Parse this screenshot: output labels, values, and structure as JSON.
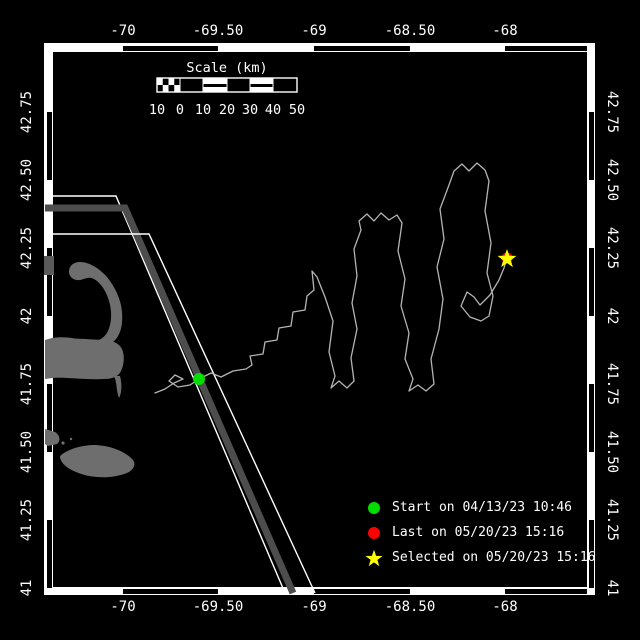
{
  "axes": {
    "top": {
      "labels": [
        "-70",
        "-69.50",
        "-69",
        "-68.50",
        "-68"
      ]
    },
    "bottom": {
      "labels": [
        "-70",
        "-69.50",
        "-69",
        "-68.50",
        "-68"
      ]
    },
    "left": {
      "labels": [
        "42.75",
        "42.50",
        "42.25",
        "42",
        "41.75",
        "41.50",
        "41.25",
        "41"
      ]
    },
    "right": {
      "labels": [
        "42.75",
        "42.50",
        "42.25",
        "42",
        "41.75",
        "41.50",
        "41.25",
        "41"
      ]
    }
  },
  "scale_bar": {
    "title": "Scale (km)",
    "tick_labels": [
      "10",
      "0",
      "10",
      "20",
      "30",
      "40",
      "50"
    ]
  },
  "legend": {
    "items": [
      {
        "icon": "start-dot-icon",
        "color": "#00dd00",
        "label": "Start on 04/13/23 10:46"
      },
      {
        "icon": "last-dot-icon",
        "color": "#ff0000",
        "label": "Last on 05/20/23 15:16"
      },
      {
        "icon": "selected-star-icon",
        "color": "#ffff00",
        "label": "Selected on 05/20/23 15:16"
      }
    ]
  },
  "colors": {
    "background": "#000000",
    "frame": "#ffffff",
    "land": "#6e6e6e",
    "shipping_lane": "#4d4d4d",
    "track": "#b4b4b4",
    "start_marker": "#00dd00",
    "last_marker": "#ff0000",
    "selected_marker": "#ffff00"
  },
  "map": {
    "start_point": {
      "x": 199,
      "y": 379
    },
    "last_point": {
      "x": 507,
      "y": 258
    },
    "selected_point": {
      "x": 507,
      "y": 259
    },
    "track_points": [
      [
        155,
        393
      ],
      [
        165,
        389
      ],
      [
        174,
        383
      ],
      [
        183,
        379
      ],
      [
        175,
        375
      ],
      [
        169,
        381
      ],
      [
        178,
        387
      ],
      [
        190,
        385
      ],
      [
        199,
        379
      ],
      [
        211,
        373
      ],
      [
        221,
        377
      ],
      [
        233,
        371
      ],
      [
        246,
        369
      ],
      [
        252,
        365
      ],
      [
        250,
        356
      ],
      [
        263,
        354
      ],
      [
        265,
        342
      ],
      [
        277,
        340
      ],
      [
        279,
        328
      ],
      [
        291,
        326
      ],
      [
        293,
        312
      ],
      [
        305,
        310
      ],
      [
        307,
        296
      ],
      [
        314,
        290
      ],
      [
        312,
        271
      ],
      [
        317,
        277
      ],
      [
        325,
        297
      ],
      [
        333,
        321
      ],
      [
        329,
        352
      ],
      [
        335,
        376
      ],
      [
        331,
        388
      ],
      [
        339,
        381
      ],
      [
        347,
        388
      ],
      [
        354,
        381
      ],
      [
        351,
        358
      ],
      [
        357,
        329
      ],
      [
        352,
        303
      ],
      [
        357,
        276
      ],
      [
        354,
        249
      ],
      [
        361,
        230
      ],
      [
        359,
        221
      ],
      [
        367,
        214
      ],
      [
        374,
        221
      ],
      [
        381,
        213
      ],
      [
        389,
        220
      ],
      [
        397,
        215
      ],
      [
        402,
        223
      ],
      [
        398,
        251
      ],
      [
        405,
        279
      ],
      [
        401,
        306
      ],
      [
        409,
        333
      ],
      [
        405,
        359
      ],
      [
        413,
        379
      ],
      [
        409,
        391
      ],
      [
        418,
        385
      ],
      [
        426,
        391
      ],
      [
        434,
        384
      ],
      [
        431,
        359
      ],
      [
        439,
        329
      ],
      [
        443,
        299
      ],
      [
        437,
        267
      ],
      [
        444,
        239
      ],
      [
        440,
        209
      ],
      [
        449,
        185
      ],
      [
        454,
        171
      ],
      [
        462,
        164
      ],
      [
        469,
        171
      ],
      [
        477,
        163
      ],
      [
        485,
        170
      ],
      [
        489,
        181
      ],
      [
        485,
        211
      ],
      [
        491,
        243
      ],
      [
        487,
        273
      ],
      [
        493,
        296
      ],
      [
        489,
        316
      ],
      [
        481,
        321
      ],
      [
        470,
        317
      ],
      [
        461,
        306
      ],
      [
        467,
        292
      ],
      [
        474,
        297
      ],
      [
        480,
        305
      ],
      [
        490,
        295
      ],
      [
        499,
        280
      ],
      [
        504,
        268
      ],
      [
        507,
        258
      ]
    ]
  }
}
